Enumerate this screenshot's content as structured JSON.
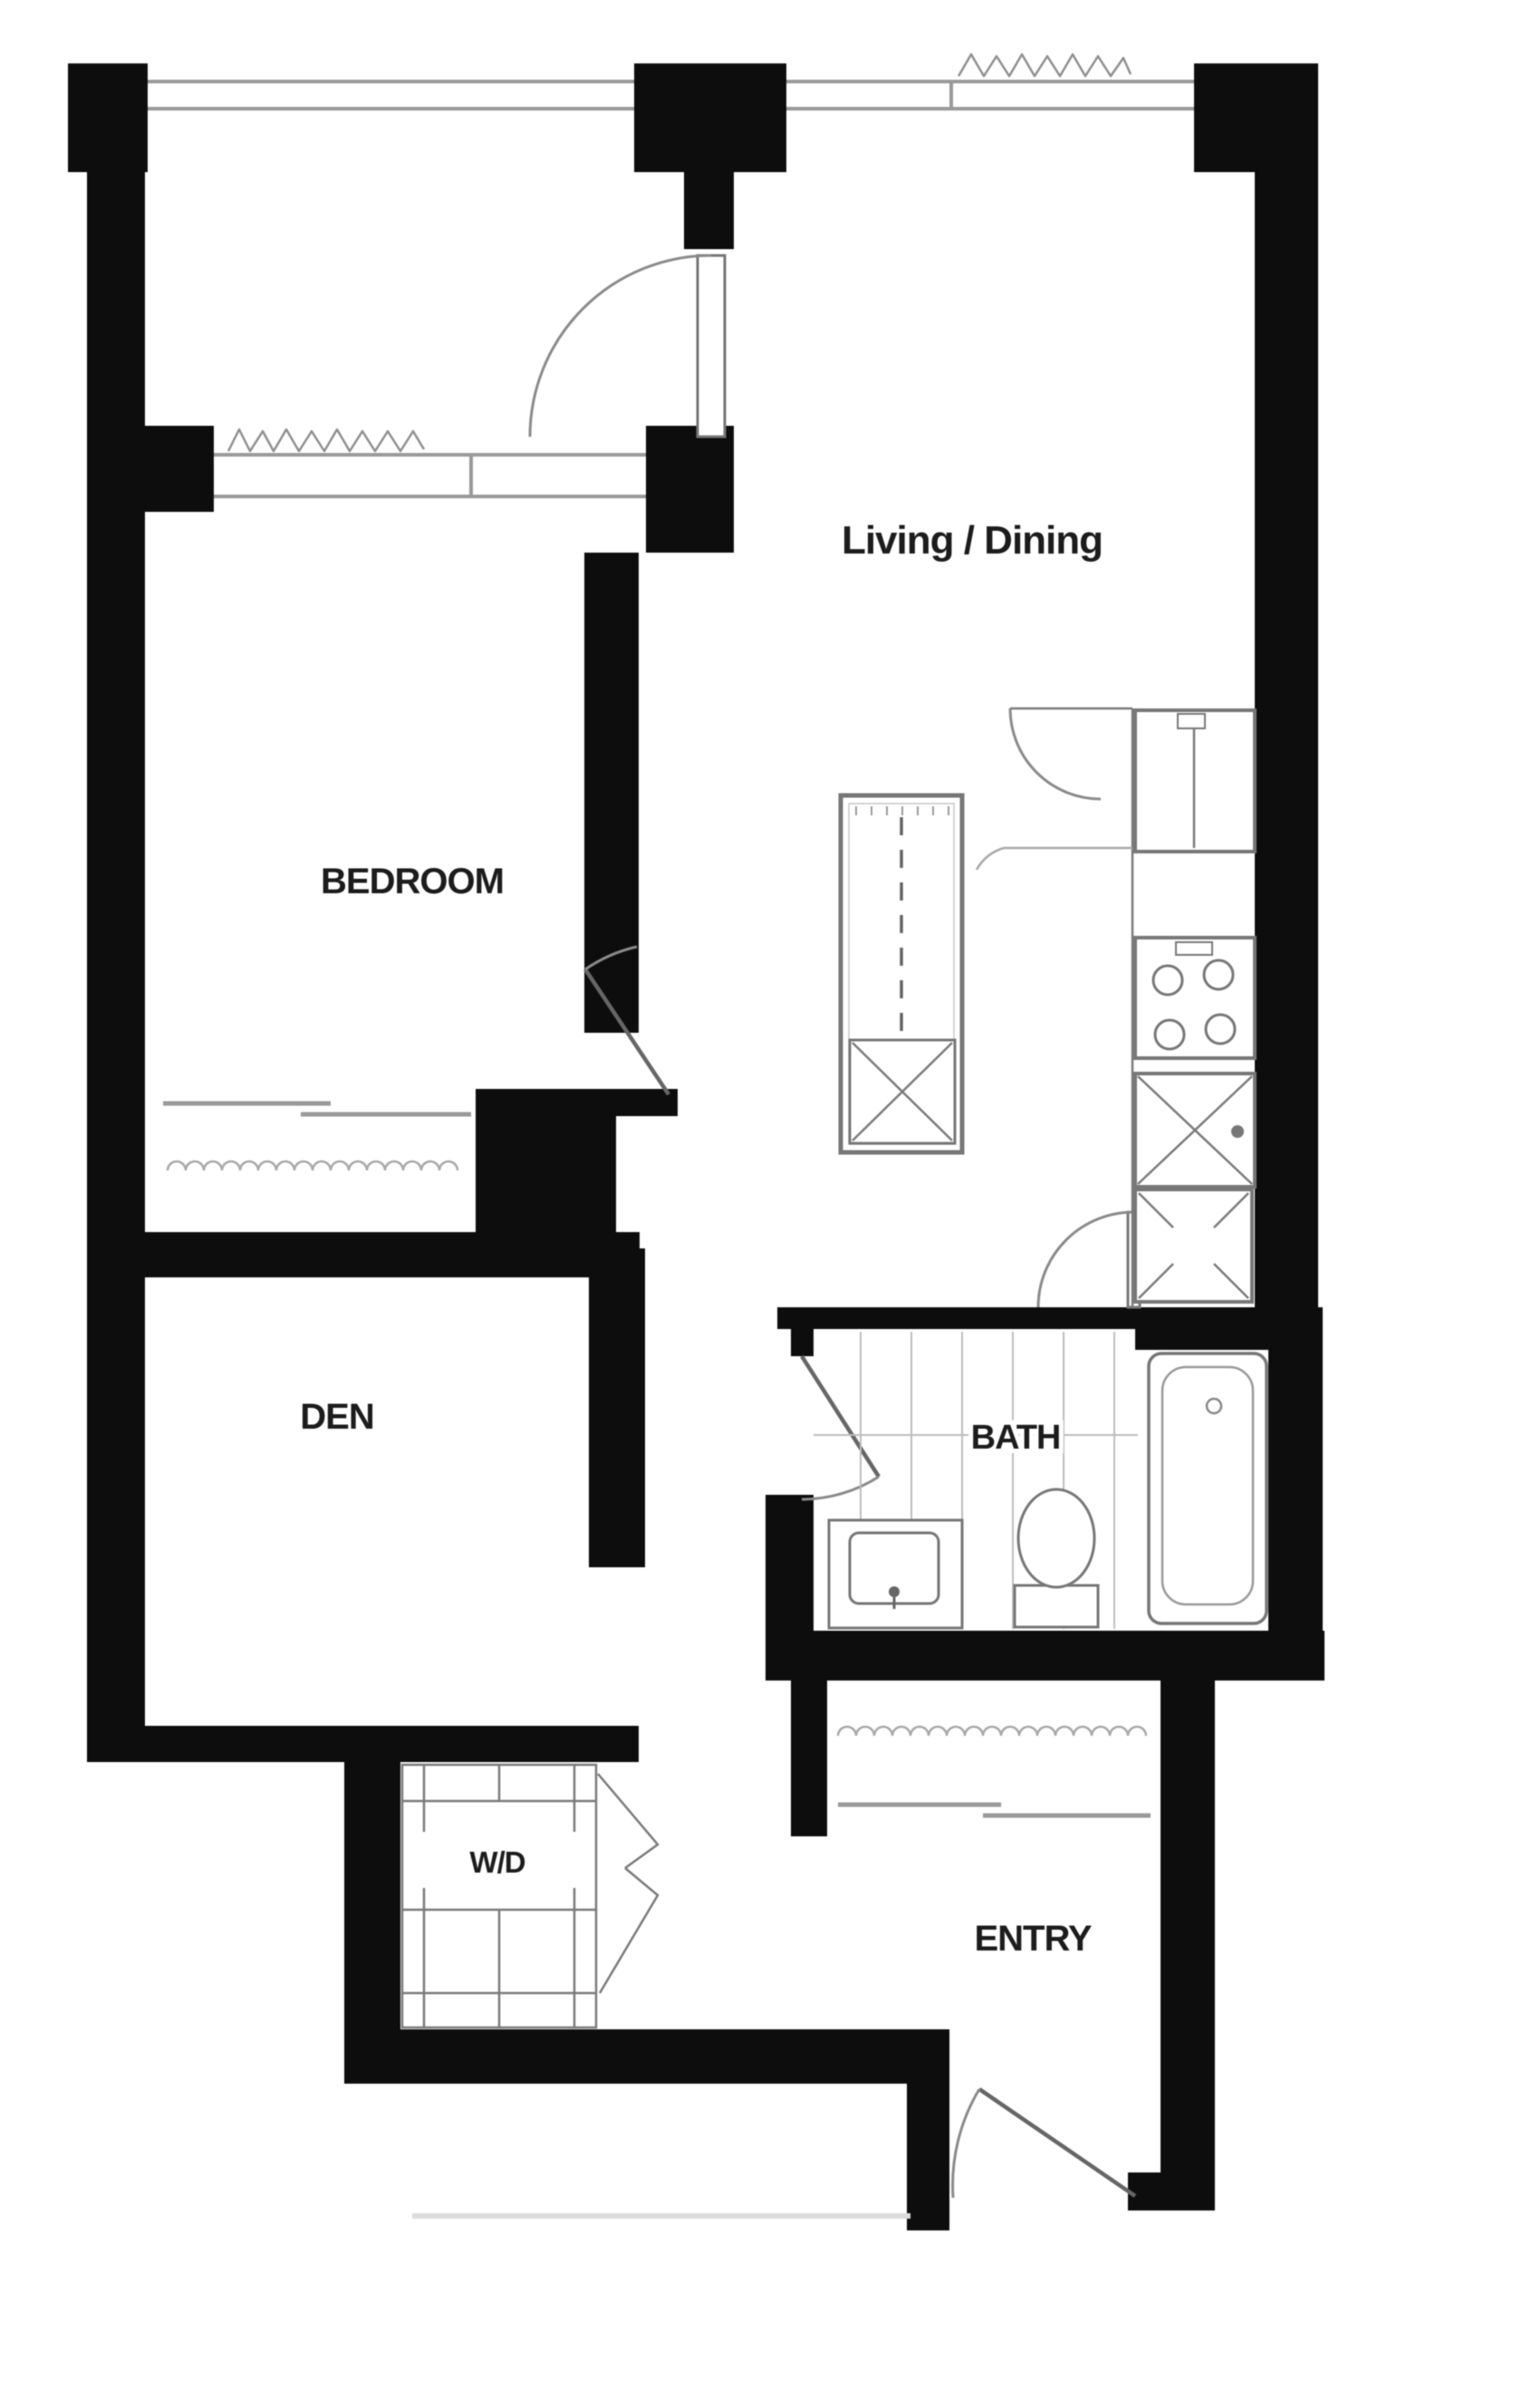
{
  "plan": {
    "rooms": {
      "living_dining": {
        "label": "Living / Dining"
      },
      "bedroom": {
        "label": "BEDROOM"
      },
      "den": {
        "label": "DEN"
      },
      "bath": {
        "label": "BATH"
      },
      "wd": {
        "label": "W/D"
      },
      "entry": {
        "label": "ENTRY"
      }
    },
    "colors": {
      "wall": "#0d0d0d",
      "line_dark": "#666666",
      "line_mid": "#9a9a9a",
      "line_light": "#c8c8c8",
      "text": "#1c1c1c",
      "background": "#ffffff"
    }
  }
}
